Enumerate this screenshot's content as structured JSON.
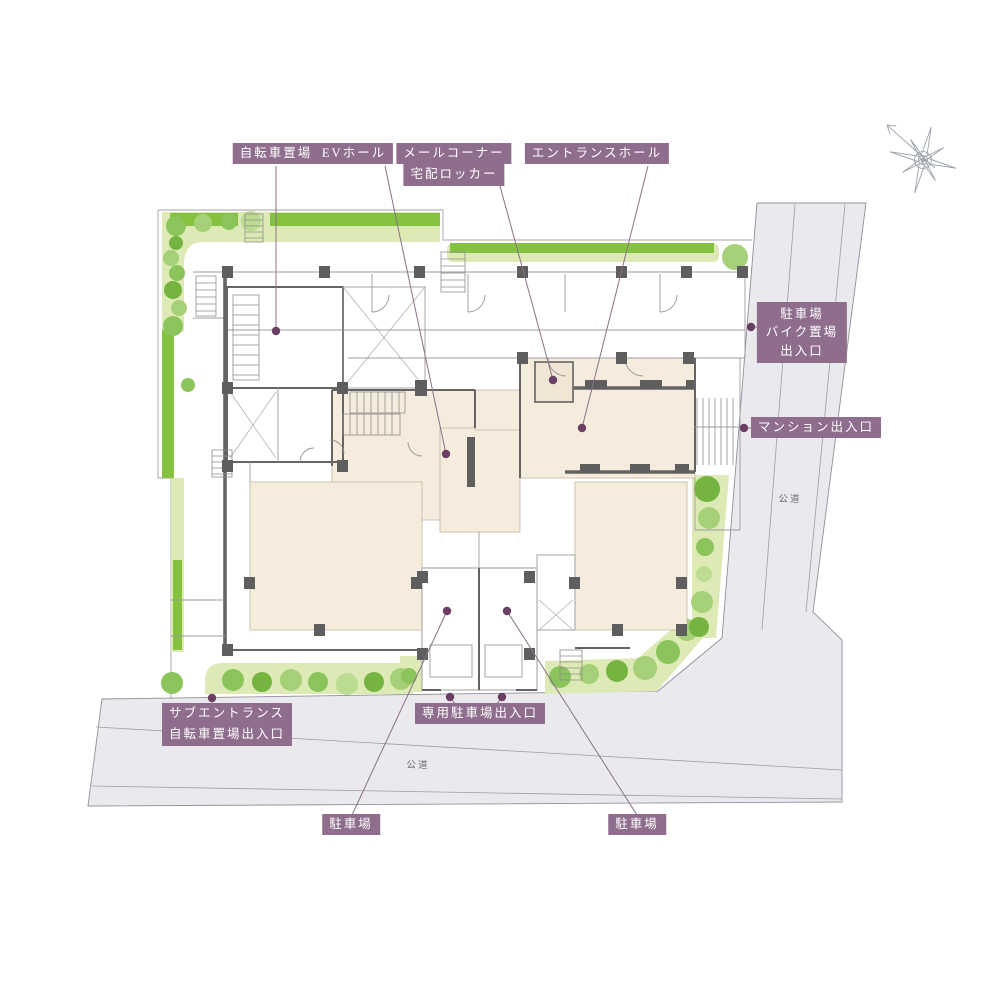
{
  "labels": {
    "bicycle_parking": "自転車置場",
    "ev_hall": "EVホール",
    "mail_corner": [
      "メールコーナー",
      "宅配ロッカー"
    ],
    "entrance_hall": "エントランスホール",
    "parking_bike_entrance": [
      "駐車場",
      "バイク置場",
      "出入口"
    ],
    "mansion_entrance": "マンション出入口",
    "sub_entrance": [
      "サブエントランス",
      "自転車置場出入口"
    ],
    "private_parking_entrance": "専用駐車場出入口",
    "parking_left": "駐車場",
    "parking_right": "駐車場",
    "road_right": "公道",
    "road_bottom": "公道"
  },
  "colors": {
    "label_bg": "#8f6e8d",
    "label_text": "#ffffff",
    "leader": "#8a7188",
    "dot": "#6b3e63",
    "road_fill": "#e9e9ee",
    "road_line": "#90909b",
    "site_line": "#a3a3aa",
    "wall": "#646464",
    "wall_light": "#9c9c9c",
    "room_beige": "#f6ecdd",
    "room_beige2": "#f1e5d4",
    "hedge_dark": "#85c23f",
    "hedge_light": "#ddeab5",
    "green_1": "#76b441",
    "green_2": "#8cc45c",
    "green_3": "#a5d077",
    "green_4": "#bcdc92",
    "compass": "#9aa2ab",
    "road_text": "#6d6d72"
  }
}
